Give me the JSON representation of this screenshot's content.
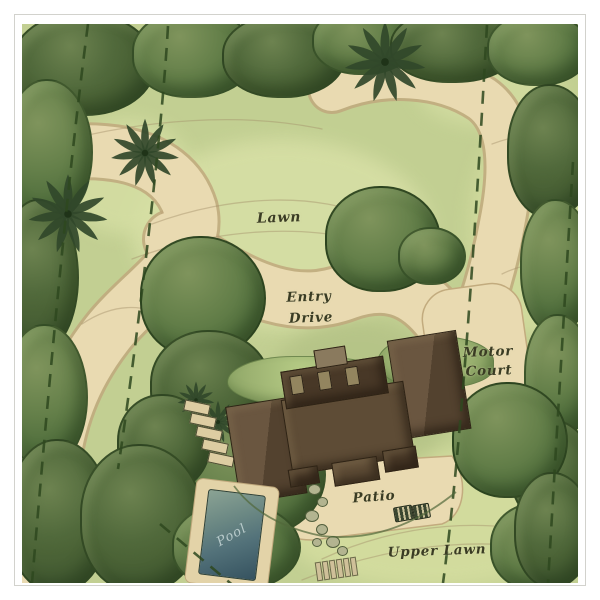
{
  "title": "Residential landscape site plan",
  "labels": {
    "lawn": "Lawn",
    "entry_drive": [
      "Entry",
      "Drive"
    ],
    "motor_court": [
      "Motor",
      "Court"
    ],
    "patio": "Patio",
    "pool": "Pool",
    "upper_lawn": "Upper Lawn"
  },
  "colors": {
    "paper": "#ffffff",
    "frame": "#d2d2cd",
    "lawn_base": "#c2cf92",
    "lawn_pale": "#d8e0a6",
    "path_tan": "#e9dab1",
    "path_edge": "#bfa87c",
    "tree_mid": "#65804a",
    "tree_dark": "#4b6336",
    "tree_outline": "#2a441f",
    "hedge": "#9cb271",
    "house_roof": "#5e4c36",
    "house_roof_dark": "#483827",
    "dormer": "#93855f",
    "pool_deep": "#35525f",
    "pool_shallow": "#8ba394",
    "label_ink": "#3a3c24",
    "property_line": "#2e481f"
  }
}
